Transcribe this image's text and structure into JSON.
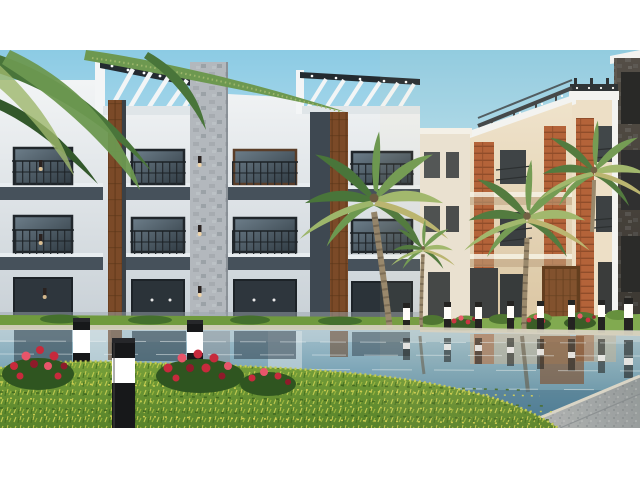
{
  "meta": {
    "type": "architectural-exterior-render",
    "description": "3D render of a modern residential compound: white three-storey apartment buildings with rooftop pergolas on the left, cream buildings with orange brick accents on the right, palm trees, a swimming pool with building reflections, black bollard path lights with glowing white bands, a foreground lawn with red flower beds, and a stone walkway at bottom right. White letterbox bars at top and bottom.",
    "letterbox": {
      "top_px": 50,
      "bottom_start_px": 428
    }
  },
  "palette": {
    "sky_top": "#8ccbe4",
    "sky_bottom": "#d8eef7",
    "wall_white": "#f3f5f6",
    "wall_shade": "#c9d1d7",
    "concrete_dark": "#46515b",
    "frame_dark": "#232a30",
    "glass_dark": "#2f3a42",
    "glass_light": "#6d7e8a",
    "wood": "#7b4a28",
    "wood_dark": "#5a3517",
    "stone": "#b3b8bd",
    "stone_dark": "#8d949a",
    "cream": "#efe5d0",
    "cream_shade": "#d9c5a4",
    "brick": "#b05c33",
    "brick_dark": "#8a4524",
    "dark_building_top": "#4a4642",
    "dark_building_bot": "#2f2d2b",
    "pool_top": "#a3c0cb",
    "pool_deep": "#47809c",
    "pool_near": "#3f6f8c",
    "coping": "#d7d2c2",
    "grass_base": "#79a23b",
    "grass_deep": "#57822a",
    "grass_light": "#c3cc52",
    "grass_dark": "#3f671f",
    "grass_far": "#6f9a3e",
    "flower_red": "#c72a3c",
    "flower_light": "#e8556a",
    "flower_dark": "#8e1b2a",
    "foliage": "#2f5520",
    "bollard_black": "#17181a",
    "bollard_glow": "#ffffff",
    "pave_light": "#b4b8bb",
    "pave_dark": "#8d9599",
    "trunk": "#94846a",
    "trunk_dark": "#675a47",
    "palm_dark": "#49753a",
    "palm_mid": "#6d9850",
    "palm_light": "#9db66b",
    "palm_yellow": "#b7b36e",
    "sconce_glow": "#ffd9a0"
  },
  "scene": {
    "sky": {
      "element": "clear-gradient-sky"
    },
    "left_building": {
      "storeys": 3,
      "rooftop_pergolas": 2,
      "wood_strips": 2,
      "stone_columns": 1,
      "wall_sconces": 6,
      "window_bays": 4
    },
    "right_buildings": {
      "blocks": 3,
      "brick_strips": 3,
      "rooftop_pergola_beams": true,
      "brown_entry_door": 1
    },
    "palms": {
      "count": 4,
      "hanging_frond_cluster_top_left": true
    },
    "pool": {
      "reflections": [
        "white piers",
        "dark windows",
        "wood door",
        "bollards",
        "palm trunks"
      ]
    },
    "bollards": {
      "foreground": 3,
      "far_row": 8
    },
    "flower_clusters": {
      "foreground": 3,
      "far": 3
    },
    "lawn": {
      "texture": "yellow-green blades"
    },
    "pavement": {
      "position": "bottom-right diagonal walkway"
    }
  }
}
